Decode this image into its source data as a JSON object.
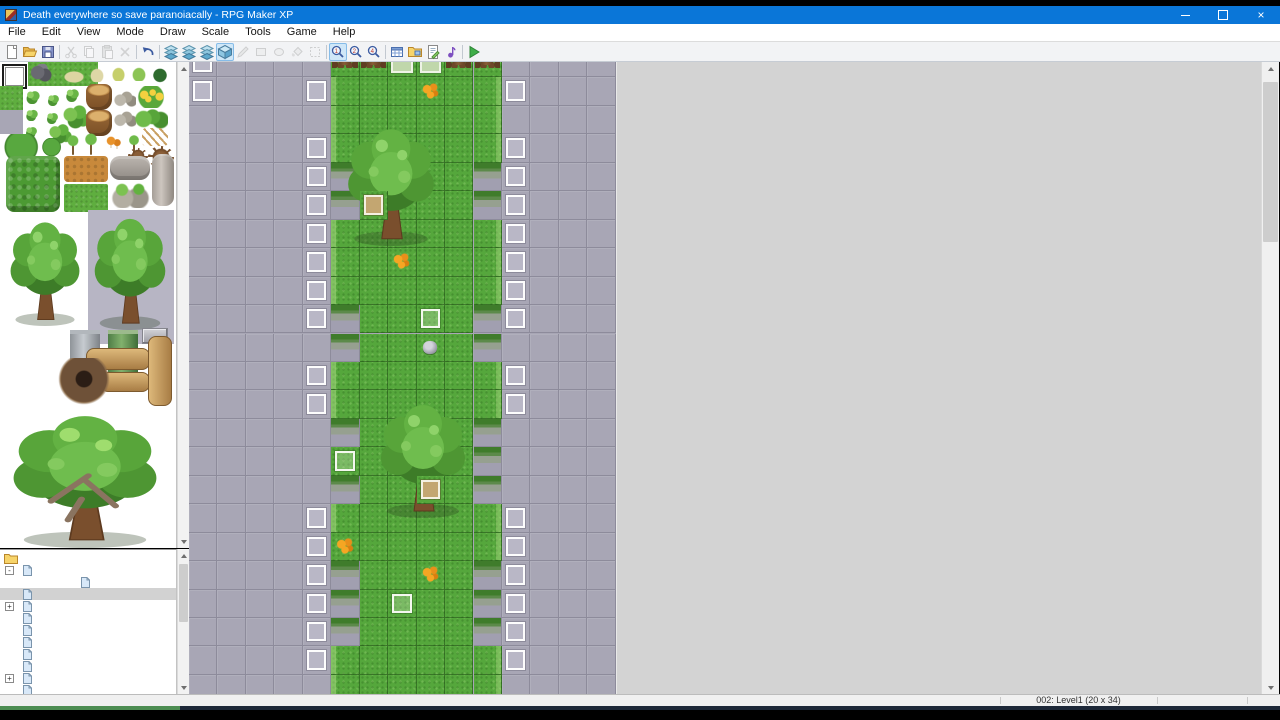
{
  "window": {
    "title": "Death everywhere so save paranoiacally - RPG Maker XP"
  },
  "menu": {
    "items": [
      "File",
      "Edit",
      "View",
      "Mode",
      "Draw",
      "Scale",
      "Tools",
      "Game",
      "Help"
    ]
  },
  "toolbar": {
    "items": [
      {
        "name": "new-project",
        "icon": "new",
        "state": "normal"
      },
      {
        "name": "open-project",
        "icon": "open",
        "state": "normal"
      },
      {
        "name": "save-project",
        "icon": "save",
        "state": "normal"
      },
      {
        "sep": true
      },
      {
        "name": "cut",
        "icon": "cut",
        "state": "disabled"
      },
      {
        "name": "copy",
        "icon": "copy",
        "state": "disabled"
      },
      {
        "name": "paste",
        "icon": "paste",
        "state": "disabled"
      },
      {
        "name": "delete",
        "icon": "delete",
        "state": "disabled"
      },
      {
        "sep": true
      },
      {
        "name": "undo",
        "icon": "undo",
        "state": "normal"
      },
      {
        "sep": true
      },
      {
        "name": "layer-1",
        "icon": "layer",
        "state": "normal"
      },
      {
        "name": "layer-2",
        "icon": "layer",
        "state": "normal"
      },
      {
        "name": "layer-3",
        "icon": "layer",
        "state": "normal"
      },
      {
        "name": "event-layer",
        "icon": "cube",
        "state": "active"
      },
      {
        "name": "pencil-tool",
        "icon": "pencil",
        "state": "disabled"
      },
      {
        "name": "rectangle-tool",
        "icon": "recttool",
        "state": "disabled"
      },
      {
        "name": "ellipse-tool",
        "icon": "ellipsetool",
        "state": "disabled"
      },
      {
        "name": "flood-fill-tool",
        "icon": "fill",
        "state": "disabled"
      },
      {
        "name": "select-tool",
        "icon": "select",
        "state": "disabled"
      },
      {
        "sep": true
      },
      {
        "name": "zoom-1-1",
        "icon": "zoom1",
        "state": "active"
      },
      {
        "name": "zoom-1-2",
        "icon": "zoom2",
        "state": "normal"
      },
      {
        "name": "zoom-1-4",
        "icon": "zoom4",
        "state": "normal"
      },
      {
        "sep": true
      },
      {
        "name": "database",
        "icon": "database",
        "state": "normal"
      },
      {
        "name": "materials",
        "icon": "materials",
        "state": "normal"
      },
      {
        "name": "script-editor",
        "icon": "script",
        "state": "normal"
      },
      {
        "name": "sound-test",
        "icon": "sound",
        "state": "normal"
      },
      {
        "sep": true
      },
      {
        "name": "playtest",
        "icon": "play",
        "state": "normal"
      }
    ]
  },
  "palette": {
    "selected_tile": "blank-eraser-tile",
    "items": [
      {
        "kind": "grass",
        "x": 28,
        "y": 0,
        "w": 70,
        "h": 24
      },
      {
        "kind": "rocks-dark",
        "x": 30,
        "y": 2,
        "w": 22,
        "h": 19
      },
      {
        "kind": "sand-patch",
        "x": 62,
        "y": 8,
        "w": 24,
        "h": 14
      },
      {
        "kind": "tile-blank-selected",
        "x": 2,
        "y": 2,
        "w": 25,
        "h": 25
      },
      {
        "kind": "grass",
        "x": 0,
        "y": 24,
        "w": 23,
        "h": 24
      },
      {
        "kind": "gray-tile",
        "x": 0,
        "y": 48,
        "w": 23,
        "h": 24
      },
      {
        "kind": "tuft-pale",
        "x": 88,
        "y": 4,
        "w": 18,
        "h": 16
      },
      {
        "kind": "tuft-yellow",
        "x": 110,
        "y": 3,
        "w": 17,
        "h": 16
      },
      {
        "kind": "tuft-green",
        "x": 130,
        "y": 3,
        "w": 18,
        "h": 16
      },
      {
        "kind": "bush-dark",
        "x": 150,
        "y": 4,
        "w": 20,
        "h": 17
      },
      {
        "kind": "bush",
        "x": 24,
        "y": 28,
        "w": 17,
        "h": 14
      },
      {
        "kind": "bush",
        "x": 46,
        "y": 32,
        "w": 14,
        "h": 12
      },
      {
        "kind": "bush",
        "x": 64,
        "y": 26,
        "w": 16,
        "h": 14
      },
      {
        "kind": "bush",
        "x": 24,
        "y": 47,
        "w": 15,
        "h": 12
      },
      {
        "kind": "bush",
        "x": 45,
        "y": 50,
        "w": 14,
        "h": 12
      },
      {
        "kind": "bush-cluster",
        "x": 62,
        "y": 43,
        "w": 28,
        "h": 24
      },
      {
        "kind": "bush",
        "x": 24,
        "y": 64,
        "w": 14,
        "h": 12
      },
      {
        "kind": "bush-cluster",
        "x": 48,
        "y": 62,
        "w": 24,
        "h": 20
      },
      {
        "kind": "stump",
        "x": 86,
        "y": 22,
        "w": 26,
        "h": 26
      },
      {
        "kind": "stump",
        "x": 86,
        "y": 48,
        "w": 26,
        "h": 26
      },
      {
        "kind": "stones",
        "x": 114,
        "y": 28,
        "w": 22,
        "h": 17
      },
      {
        "kind": "stones",
        "x": 114,
        "y": 48,
        "w": 22,
        "h": 17
      },
      {
        "kind": "flowers-yellow",
        "x": 134,
        "y": 24,
        "w": 34,
        "h": 22
      },
      {
        "kind": "bushes-green",
        "x": 134,
        "y": 46,
        "w": 34,
        "h": 22
      },
      {
        "kind": "lilypad",
        "x": 2,
        "y": 72,
        "w": 40,
        "h": 26
      },
      {
        "kind": "lilypad",
        "x": 42,
        "y": 76,
        "w": 20,
        "h": 18
      },
      {
        "kind": "sapling",
        "x": 66,
        "y": 72,
        "w": 14,
        "h": 24
      },
      {
        "kind": "sapling",
        "x": 84,
        "y": 70,
        "w": 14,
        "h": 26
      },
      {
        "kind": "mushrooms",
        "x": 104,
        "y": 72,
        "w": 20,
        "h": 18
      },
      {
        "kind": "sapling",
        "x": 128,
        "y": 72,
        "w": 12,
        "h": 22
      },
      {
        "kind": "sticks",
        "x": 142,
        "y": 66,
        "w": 26,
        "h": 18
      },
      {
        "kind": "roots",
        "x": 128,
        "y": 86,
        "w": 20,
        "h": 16
      },
      {
        "kind": "roots",
        "x": 148,
        "y": 84,
        "w": 26,
        "h": 22
      },
      {
        "kind": "hedge",
        "x": 6,
        "y": 94,
        "w": 54,
        "h": 56
      },
      {
        "kind": "dirt-block",
        "x": 64,
        "y": 94,
        "w": 44,
        "h": 26
      },
      {
        "kind": "grass-bright",
        "x": 64,
        "y": 122,
        "w": 44,
        "h": 28
      },
      {
        "kind": "log-gray",
        "x": 110,
        "y": 94,
        "w": 40,
        "h": 24
      },
      {
        "kind": "rocks-mossy",
        "x": 110,
        "y": 120,
        "w": 40,
        "h": 26
      },
      {
        "kind": "log-tall",
        "x": 152,
        "y": 92,
        "w": 22,
        "h": 52
      },
      {
        "kind": "pebbles",
        "x": 112,
        "y": 146,
        "w": 30,
        "h": 11
      },
      {
        "kind": "gray-patch",
        "x": 88,
        "y": 148,
        "w": 86,
        "h": 134
      },
      {
        "kind": "tree-large",
        "x": 4,
        "y": 154,
        "w": 82,
        "h": 110
      },
      {
        "kind": "tree-large",
        "x": 88,
        "y": 150,
        "w": 84,
        "h": 118
      },
      {
        "kind": "pillar-gray",
        "x": 70,
        "y": 268,
        "w": 30,
        "h": 60
      },
      {
        "kind": "pillar-green",
        "x": 108,
        "y": 268,
        "w": 30,
        "h": 62
      },
      {
        "kind": "stone-blocks",
        "x": 142,
        "y": 266,
        "w": 26,
        "h": 16
      },
      {
        "kind": "log-tan-h",
        "x": 86,
        "y": 286,
        "w": 64,
        "h": 22
      },
      {
        "kind": "log-tan-h",
        "x": 100,
        "y": 310,
        "w": 50,
        "h": 20
      },
      {
        "kind": "log-tan-v",
        "x": 148,
        "y": 274,
        "w": 24,
        "h": 70
      },
      {
        "kind": "trunk-hole",
        "x": 58,
        "y": 296,
        "w": 52,
        "h": 50
      },
      {
        "kind": "big-tree",
        "x": 0,
        "y": 346,
        "w": 170,
        "h": 140
      }
    ]
  },
  "project_tree": {
    "root": "Death everywhere so save paranoiacally",
    "items": [
      {
        "label": "Level0",
        "indent": 1,
        "toggle": "-",
        "selected": false
      },
      {
        "label": "In the Tent",
        "indent": 2,
        "toggle": "",
        "selected": false
      },
      {
        "label": "Level1",
        "indent": 1,
        "toggle": "",
        "selected": true
      },
      {
        "label": "Level2",
        "indent": 1,
        "toggle": "+",
        "selected": false
      },
      {
        "label": "Level3",
        "indent": 1,
        "toggle": "",
        "selected": false
      },
      {
        "label": "Level4",
        "indent": 1,
        "toggle": "",
        "selected": false
      },
      {
        "label": "Level5",
        "indent": 1,
        "toggle": "",
        "selected": false
      },
      {
        "label": "Level6",
        "indent": 1,
        "toggle": "",
        "selected": false
      },
      {
        "label": "Level7",
        "indent": 1,
        "toggle": "",
        "selected": false
      },
      {
        "label": "Level8",
        "indent": 1,
        "toggle": "+",
        "selected": false
      },
      {
        "label": "Level9",
        "indent": 1,
        "toggle": "",
        "selected": false
      }
    ]
  },
  "map": {
    "cell_size": 28.45,
    "cols": 15,
    "visible_rows": 23,
    "legend": {
      "G": "gray-tile",
      "E": "event-box-on-gray",
      "F": "grass-tile",
      "L": "grass-left-edge",
      "R": "grass-right-edge",
      "C": "cliff-ledge-tile",
      "v": "event-box-on-grass",
      "d": "event-box-dirt",
      "n": "event-box-green",
      "t": "tree-trunk-top",
      "o": "orange-flowers",
      "r": "small-rock"
    },
    "rows": [
      "EGGGGttnnttGGGG",
      "EGGGELFFoFREGGG",
      "GGGGGLFFFFRGGGG",
      "GGGGELFFFFREGGG",
      "GGGGECFFFFCEGGG",
      "GGGGECdFFFCEGGG",
      "GGGGELFFFFREGGG",
      "GGGGELFoFFREGGG",
      "GGGGELFFFFREGGG",
      "GGGGECFFvFCEGGG",
      "GGGGGCFFrFCGGGG",
      "GGGGELFFFFREGGG",
      "GGGGELFFFFREGGG",
      "GGGGGCFFFFCGGGG",
      "GGGGGvFFFFCGGGG",
      "GGGGGCFFdFCGGGG",
      "GGGGELFFFFREGGG",
      "GGGGEoFFFFREGGG",
      "GGGGECFFoFCEGGG",
      "GGGGECFvFFCEGGG",
      "GGGGECFFFFCEGGG",
      "GGGGELFFFFREGGG",
      "GGGGGLFFFFRGGGG"
    ],
    "trees": [
      {
        "x": 151,
        "y": 73,
        "w": 102,
        "h": 124
      },
      {
        "x": 184,
        "y": 349,
        "w": 100,
        "h": 120
      }
    ]
  },
  "status_bar": {
    "map_info": "002: Level1 (20 x 34)",
    "separators_x": [
      1000,
      1157,
      1247
    ]
  },
  "colors": {
    "titlebar_blue": "#0a76d8",
    "map_gray_tile": "#a8a6b5",
    "map_grass": "#55a73c",
    "editor_background": "#d3d3d3",
    "progress_green": "#4d8d52",
    "toolbar_active_bg": "#cfe7f8"
  }
}
